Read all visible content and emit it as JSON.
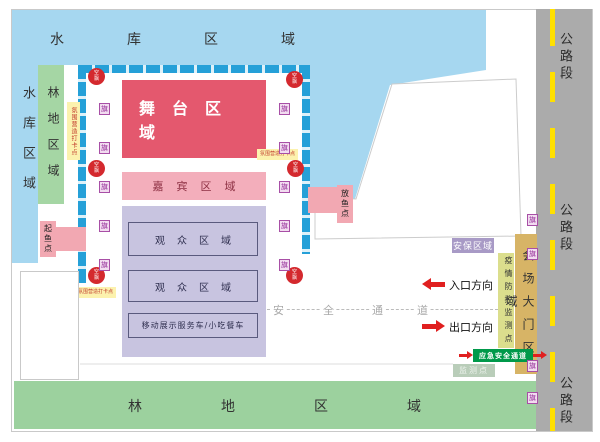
{
  "areas": {
    "reservoir_top": "水库区域",
    "reservoir_left": "水库区域",
    "forest_left": "林地区域",
    "forest_bottom": "林地区域",
    "road_section": "公路段",
    "stage": "舞台区域",
    "guest": "嘉宾区域",
    "audience": "观众区域",
    "vehicle": "移动展示服务车/小吃餐车",
    "security": "安保区域",
    "gate": "会场大门区域",
    "epidemic_monitor": "疫情防控监测点",
    "emergency_passage": "应急安全通道",
    "monitor_point": "监测点"
  },
  "points": {
    "fish_release": "放鱼点",
    "fish_lift": "起鱼点",
    "checkin": "氛围营造打卡点"
  },
  "passage": {
    "c1": "安",
    "c2": "全",
    "c3": "通",
    "c4": "道"
  },
  "directions": {
    "entrance": "入口方向",
    "exit": "出口方向"
  },
  "badges": {
    "balloon_top": "空",
    "balloon_bottom": "飘",
    "flag": "旗"
  },
  "colors": {
    "water": "#A6D7F0",
    "frame_blue": "#25A0D8",
    "stage_red": "#E4586E",
    "guest_pink": "#F3AEBB",
    "audience_lavender": "#C8C4E0",
    "forest_green": "#A5D6A4",
    "bottom_green": "#9CD19E",
    "road_gray": "#ABABAB",
    "road_line_yellow": "#FFE000",
    "gate_tan": "#D7B466",
    "epidemic_yellowgreen": "#DBDE8D",
    "emergency_green": "#00994A",
    "security_purple": "#A89AC6",
    "monitor_graygreen": "#B9CDB9",
    "fish_pink": "#F2A8B2",
    "checkin_yellow": "#FCF2AE",
    "balloon_red": "#D4292E",
    "flag_purple": "#A84FA6",
    "arrow_red": "#E01F1F"
  }
}
